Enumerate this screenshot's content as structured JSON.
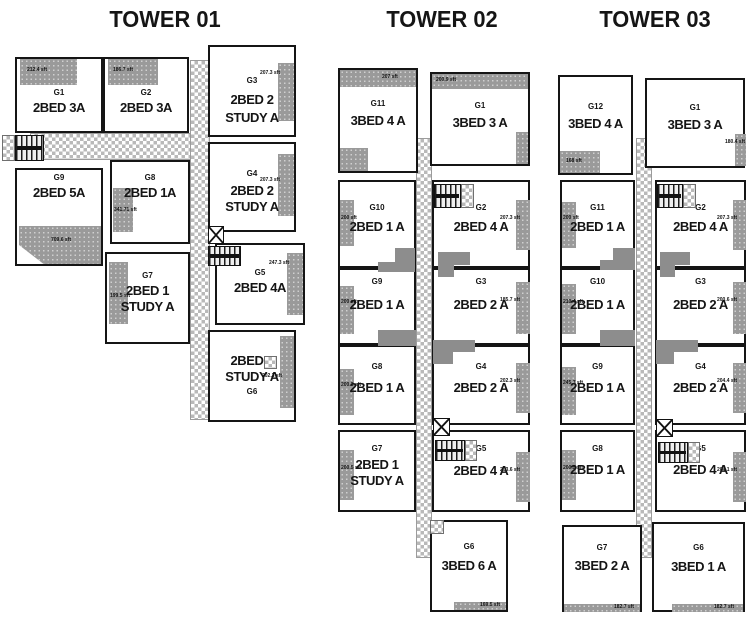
{
  "colors": {
    "line_black": "#151515",
    "patch_gray": "#9a9a9a",
    "checker_gray": "#b9b9b9",
    "shaft_gray": "#8d8d8d",
    "background": "#ffffff"
  },
  "icons": {
    "corridor": "checker-hatch",
    "stairs": "stair-treads",
    "elevator": "x-box"
  },
  "towers": [
    {
      "title": "TOWER 01",
      "units": [
        {
          "id": "G1",
          "line1": "2BED 3A",
          "line2": "",
          "area": "212.4 sft"
        },
        {
          "id": "G2",
          "line1": "2BED 3A",
          "line2": "",
          "area": "186.7 sft"
        },
        {
          "id": "G3",
          "line1": "2BED 2",
          "line2": "STUDY A",
          "area": "207.3 sft"
        },
        {
          "id": "G9",
          "line1": "2BED 5A",
          "line2": "",
          "area": "709.6 sft"
        },
        {
          "id": "G8",
          "line1": "2BED 1A",
          "line2": "",
          "area": "341.71 sft"
        },
        {
          "id": "G4",
          "line1": "2BED 2",
          "line2": "STUDY A",
          "area": "207.3 sft"
        },
        {
          "id": "G7",
          "line1": "2BED 1",
          "line2": "STUDY A",
          "area": "199.5 sft"
        },
        {
          "id": "G5",
          "line1": "2BED 4A",
          "line2": "",
          "area": "247.3 sft"
        },
        {
          "id": "G6",
          "line1": "2BED 2",
          "line2": "STUDY A",
          "area": "202.3 sft"
        }
      ]
    },
    {
      "title": "TOWER 02",
      "units": [
        {
          "id": "G11",
          "line1": "3BED 4 A",
          "line2": "",
          "area": "207 sft"
        },
        {
          "id": "G1",
          "line1": "3BED 3 A",
          "line2": "",
          "area": "200.9 sft"
        },
        {
          "id": "G10",
          "line1": "2BED 1 A",
          "line2": "",
          "area": "200 sft"
        },
        {
          "id": "G2",
          "line1": "2BED 4 A",
          "line2": "",
          "area": "207.3 sft"
        },
        {
          "id": "G9",
          "line1": "2BED 1 A",
          "line2": "",
          "area": "200 sft"
        },
        {
          "id": "G3",
          "line1": "2BED 2 A",
          "line2": "",
          "area": "185.7 sft"
        },
        {
          "id": "G8",
          "line1": "2BED 1 A",
          "line2": "",
          "area": "200.3 sft"
        },
        {
          "id": "G4",
          "line1": "2BED 2 A",
          "line2": "",
          "area": "202.3 sft"
        },
        {
          "id": "G7",
          "line1": "2BED 1",
          "line2": "STUDY A",
          "area": "200.5 sft"
        },
        {
          "id": "G5",
          "line1": "2BED 4 A",
          "line2": "",
          "area": "203.6 sft"
        },
        {
          "id": "G6",
          "line1": "3BED 6 A",
          "line2": "",
          "area": "169.5 sft"
        }
      ]
    },
    {
      "title": "TOWER 03",
      "units": [
        {
          "id": "G12",
          "line1": "3BED 4 A",
          "line2": "",
          "area": "168 sft"
        },
        {
          "id": "G1",
          "line1": "3BED 3 A",
          "line2": "",
          "area": "180.4 sft"
        },
        {
          "id": "G11",
          "line1": "2BED 1 A",
          "line2": "",
          "area": "200 sft"
        },
        {
          "id": "G2",
          "line1": "2BED 4 A",
          "line2": "",
          "area": "207.3 sft"
        },
        {
          "id": "G10",
          "line1": "2BED 1 A",
          "line2": "",
          "area": "210.4 sft"
        },
        {
          "id": "G3",
          "line1": "2BED 2 A",
          "line2": "",
          "area": "200.6 sft"
        },
        {
          "id": "G9",
          "line1": "2BED 1 A",
          "line2": "",
          "area": "245.7 sft"
        },
        {
          "id": "G4",
          "line1": "2BED 2 A",
          "line2": "",
          "area": "204.4 sft"
        },
        {
          "id": "G8",
          "line1": "2BED 1 A",
          "line2": "",
          "area": "200.5 sft"
        },
        {
          "id": "G5",
          "line1": "2BED 4 A",
          "line2": "",
          "area": "204.1 sft"
        },
        {
          "id": "G7",
          "line1": "3BED 2 A",
          "line2": "",
          "area": "182.7 sft"
        },
        {
          "id": "G6",
          "line1": "3BED 1 A",
          "line2": "",
          "area": "182.7 sft"
        }
      ]
    }
  ]
}
